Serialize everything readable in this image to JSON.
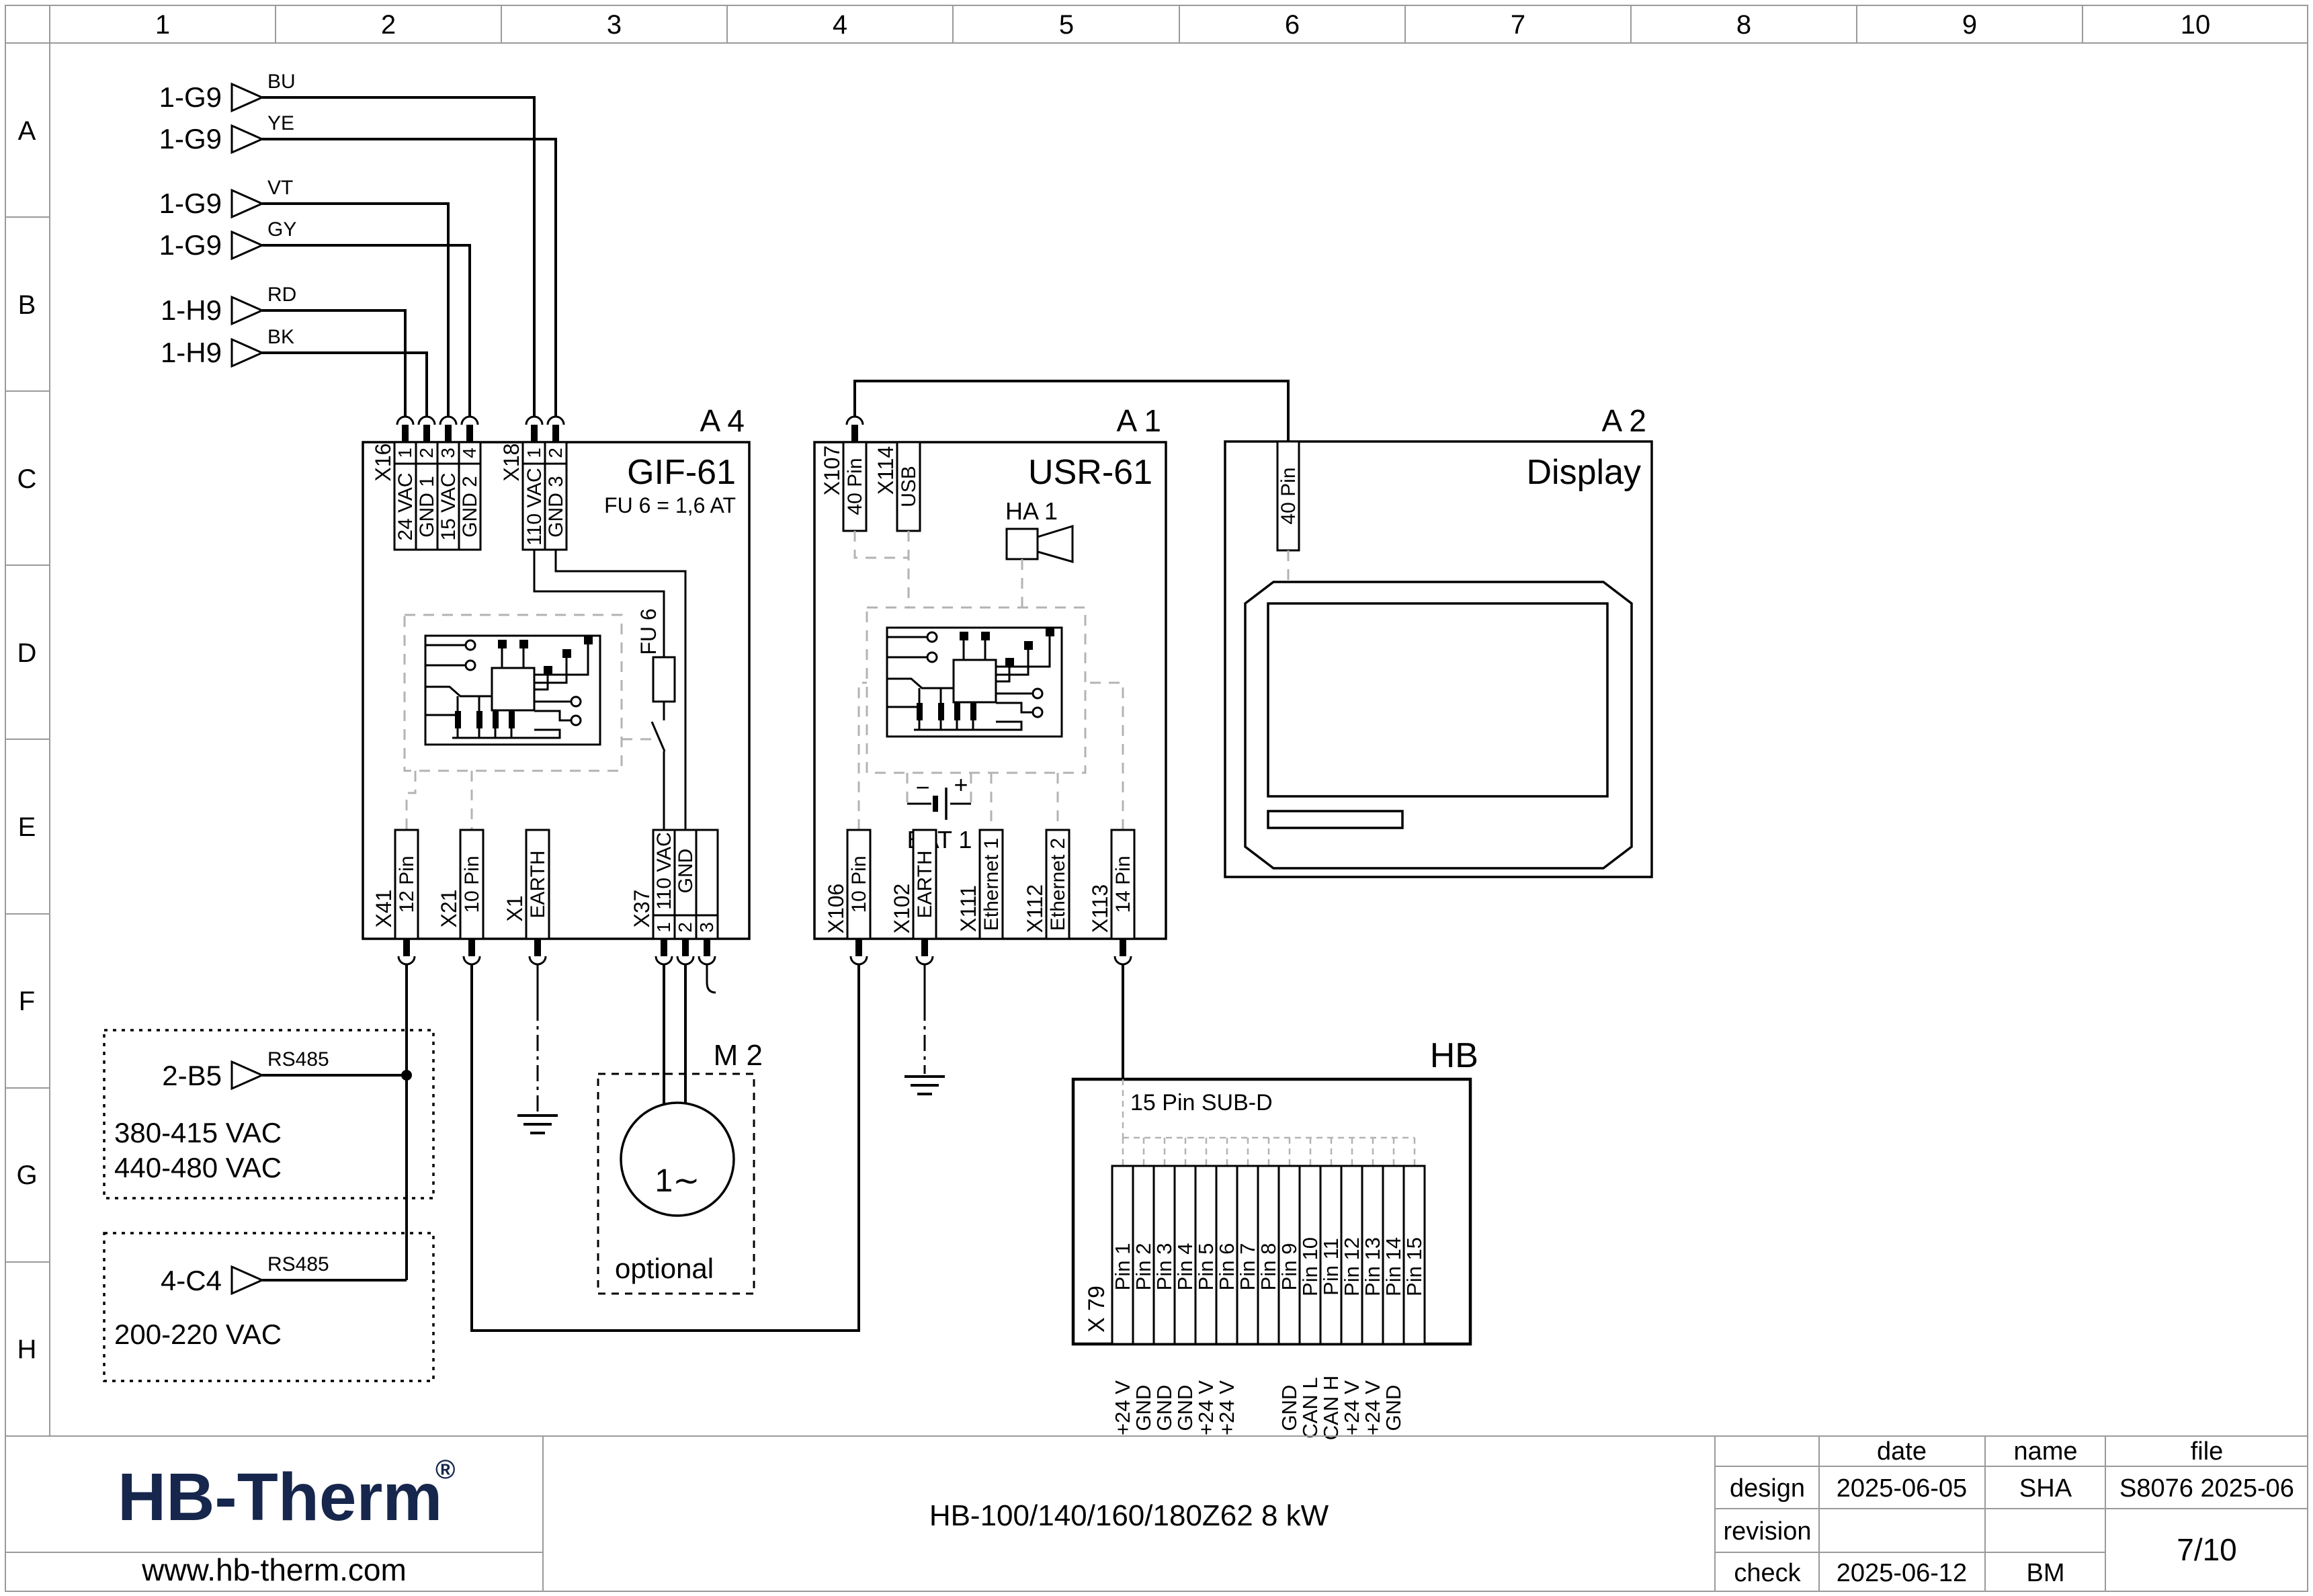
{
  "page": {
    "brand_color": "#16264c",
    "schematic_color": "#000000"
  },
  "grid": {
    "cols": [
      "1",
      "2",
      "3",
      "4",
      "5",
      "6",
      "7",
      "8",
      "9",
      "10"
    ],
    "rows": [
      "A",
      "B",
      "C",
      "D",
      "E",
      "F",
      "G",
      "H"
    ]
  },
  "inputs": [
    {
      "ref": "1-G9",
      "color": "BU"
    },
    {
      "ref": "1-G9",
      "color": "YE"
    },
    {
      "ref": "1-G9",
      "color": "VT"
    },
    {
      "ref": "1-G9",
      "color": "GY"
    },
    {
      "ref": "1-H9",
      "color": "RD"
    },
    {
      "ref": "1-H9",
      "color": "BK"
    }
  ],
  "a4": {
    "tag": "A 4",
    "title": "GIF-61",
    "subtitle": "FU 6 = 1,6 AT",
    "fu6": "FU 6",
    "x16": {
      "name": "X16",
      "pins": [
        "1",
        "2",
        "3",
        "4"
      ],
      "labels": [
        "24 VAC",
        "GND 1",
        "15 VAC",
        "GND 2"
      ]
    },
    "x18": {
      "name": "X18",
      "pins": [
        "1",
        "2"
      ],
      "labels": [
        "110 VAC",
        "GND 3"
      ]
    },
    "x41": {
      "name": "X41",
      "label": "12 Pin"
    },
    "x21": {
      "name": "X21",
      "label": "10 Pin"
    },
    "x1": {
      "name": "X1",
      "label": "EARTH"
    },
    "x37": {
      "name": "X37",
      "labels": [
        "110 VAC",
        "GND"
      ],
      "pins": [
        "1",
        "2",
        "3"
      ]
    }
  },
  "a1": {
    "tag": "A 1",
    "title": "USR-61",
    "x107": {
      "name": "X107",
      "label": "40 Pin"
    },
    "x114": {
      "name": "X114",
      "label": "USB"
    },
    "ha1": "HA 1",
    "bat": {
      "label": "BAT 1",
      "minus": "−",
      "plus": "+"
    },
    "x106": {
      "name": "X106",
      "label": "10 Pin"
    },
    "x102": {
      "name": "X102",
      "label": "EARTH"
    },
    "x111": {
      "name": "X111",
      "label": "Ethernet 1"
    },
    "x112": {
      "name": "X112",
      "label": "Ethernet 2"
    },
    "x113": {
      "name": "X113",
      "label": "14 Pin"
    }
  },
  "a2": {
    "tag": "A 2",
    "title": "Display",
    "conn": "40 Pin"
  },
  "m2": {
    "tag": "M 2",
    "symbol": "1∼",
    "note": "optional"
  },
  "hb": {
    "tag": "HB",
    "header": "15 Pin SUB-D",
    "name": "X 79",
    "pins": [
      "Pin 1",
      "Pin 2",
      "Pin 3",
      "Pin 4",
      "Pin 5",
      "Pin 6",
      "Pin 7",
      "Pin 8",
      "Pin 9",
      "Pin 10",
      "Pin 11",
      "Pin 12",
      "Pin 13",
      "Pin 14",
      "Pin 15"
    ],
    "functions": [
      "+24 V",
      "GND",
      "GND",
      "GND",
      "+24 V",
      "+24 V",
      "",
      "",
      "GND",
      "CAN L",
      "CAN H",
      "+24 V",
      "+24 V",
      "GND",
      ""
    ]
  },
  "feeds": [
    {
      "ref": "2-B5",
      "bus": "RS485",
      "volt1": "380-415 VAC",
      "volt2": "440-480 VAC"
    },
    {
      "ref": "4-C4",
      "bus": "RS485",
      "volt1": "200-220 VAC"
    }
  ],
  "titleblock": {
    "logo": "HB-Therm",
    "reg": "®",
    "website": "www.hb-therm.com",
    "doc": "HB-100/140/160/180Z62 8 kW",
    "col_date": "date",
    "col_name": "name",
    "col_file": "file",
    "design_label": "design",
    "design_date": "2025-06-05",
    "design_name": "SHA",
    "file_no": "S8076 2025-06",
    "revision_label": "revision",
    "check_label": "check",
    "check_date": "2025-06-12",
    "check_name": "BM",
    "page": "7/10"
  }
}
